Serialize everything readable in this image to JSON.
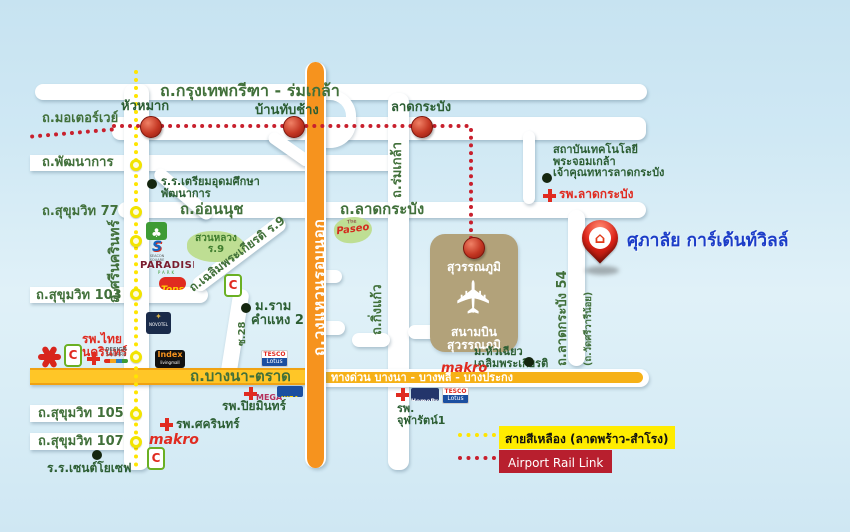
{
  "project": {
    "name": "ศุภาลัย การ์เด้นท์วิลล์"
  },
  "roads": {
    "krungthep_kritha": "ถ.กรุงเทพกรีฑา - ร่มเกล้า",
    "motorway": "ถ.มอเตอร์เวย์",
    "pattanakan": "ถ.พัฒนาการ",
    "sukhumvit_77": "ถ.สุขุมวิท 77",
    "on_nut": "ถ.อ่อนนุช",
    "srinakarin": "ถ.ศรีนครินทร์",
    "sukhumvit_103": "ถ.สุขุมวิท 103",
    "chalermprakiat_r9": "ถ.เฉลิมพระเกียรติ ร.9",
    "soi_28": "ซ.28",
    "lat_krabang": "ถ.ลาดกระบัง",
    "rom_klao": "ถ.ร่มเกล้า",
    "outer_ring": "ถ.วงแหวนรอบนอก",
    "king_kaew": "ถ.กิ่งแก้ว",
    "lat_krabang_54": "ถ.ลาดกระบัง 54",
    "wat_sri_wari_noi": "(ถ.วัดศรีวารีน้อย)",
    "bangna_trad": "ถ.บางนา-ตราด",
    "expressway": "ทางด่วน บางนา - บางพลี - บางประกง",
    "sukhumvit_105": "ถ.สุขุมวิท 105",
    "sukhumvit_107": "ถ.สุขุมวิท 107"
  },
  "stations": {
    "hua_mak": "หัวหมาก",
    "ban_thap_chang": "บ้านทับช้าง",
    "lat_krabang": "ลาดกระบัง",
    "suvarnabhumi": "สุวรรณภูมิ"
  },
  "airport": {
    "line1": "สนามบิน",
    "line2": "สุวรรณภูมิ"
  },
  "places": {
    "triam_udom_line1": "ร.ร.เตรียมอุดมศึกษา",
    "triam_udom_line2": "พัฒนาการ",
    "suan_luang_line1": "สวนหลวง",
    "suan_luang_line2": "ร.9",
    "kmitl_line1": "สถาบันเทคโนโลยี",
    "kmitl_line2": "พระจอมเกล้า",
    "kmitl_line3": "เจ้าคุณทหารลาดกระบัง",
    "lat_krabang_hospital": "รพ.ลาดกระบัง",
    "ramkhamhaeng2_line1": "ม.ราม",
    "ramkhamhaeng2_line2": "คำแหง 2",
    "thai_nakarin_line1": "รพ.ไทย",
    "thai_nakarin_line2": "นครินทร์",
    "hua_chiew_line1": "ม.หัวเฉียว",
    "hua_chiew_line2": "เฉลิมพระเกียรติ",
    "piyamin_hospital": "รพ.ปิยมินทร์",
    "sikarin_hospital": "รพ.ศครินทร์",
    "chularat_line1": "รพ.",
    "chularat_line2": "จุฬารัตน์1",
    "st_joseph": "ร.ร.เซนต์โยเซฟ"
  },
  "logos": {
    "paseo_the": "The",
    "paseo": "Paseo",
    "paradise": "PARADISE",
    "paradise_sub": "PARK",
    "tops": "Tops",
    "seacon": "S",
    "seacon_sub": "SEACON SQUARE",
    "novotel": "NOVOTEL",
    "index": "Index",
    "index_sub": "livingmall",
    "tesco": "TESCO",
    "tesco_sub": "Lotus",
    "makro": "makro",
    "mega": "MEGA",
    "ikea": "IKEA",
    "homepro": "HomePro",
    "bigc": "C",
    "design_line1": "DESIGN",
    "design_line2": "SQUARE"
  },
  "legend": {
    "yellow_line": "สายสีเหลือง (ลาดพร้าว-สำโรง)",
    "arl": "Airport Rail Link"
  },
  "colors": {
    "accent_blue": "#1c3dc8",
    "road_orange": "#f6931e",
    "road_yellow": "#ffc627",
    "arl_red": "#c8202d",
    "yellow_line": "#ffe500",
    "label_green": "#41703a",
    "hospital_red": "#e02b20"
  }
}
